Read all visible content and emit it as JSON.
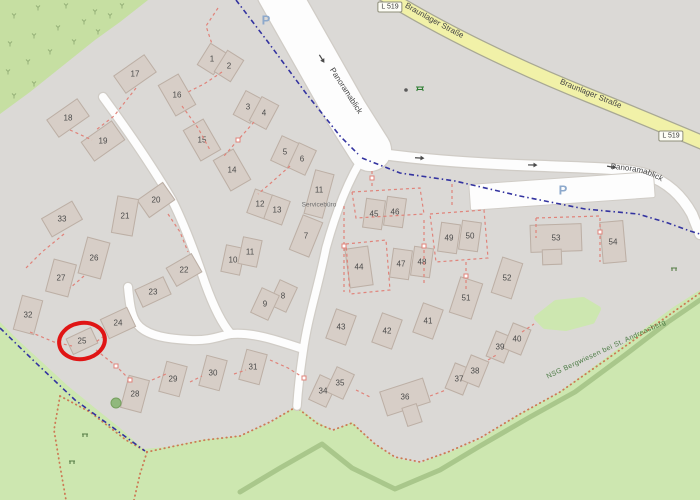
{
  "map": {
    "road_labels": {
      "main_street": "Braunlager Straße",
      "main_street_ref": "L 519",
      "residential_street": "Panoramablick"
    },
    "parking_label": "P",
    "protected_area_label": "NSG Bergwiesen bei St. Andreasberg",
    "service_building_label": "Servicebüro",
    "annotation": {
      "type": "red-circle",
      "around_housenumber": "25",
      "x": 82,
      "y": 341,
      "rx": 23,
      "ry": 18,
      "rotate": -10,
      "color": "#e01515"
    },
    "colors": {
      "background": "#dbd9d6",
      "green_top": "#c6dfa2",
      "green_bottom": "#cde7b0",
      "scrub_mark": "#95b078",
      "treeline": "#a9c78b",
      "building_fill": "#d7cec7",
      "building_stroke": "#bcafa5",
      "road_white": "#fdfdfd",
      "road_casing": "#d0ccc6",
      "road_yellow": "#f1f1a8",
      "road_yellow_casing": "#a8a894",
      "boundary_blue": "#3333a0",
      "parcel_red": "#e0837a",
      "path_orange": "#cc7a55",
      "label_gray": "#4a4a4a",
      "nsg_green": "#4a7a43",
      "annotation_red": "#e01515"
    },
    "buildings": [
      {
        "n": "1",
        "x": 212,
        "y": 59,
        "w": 20,
        "h": 26,
        "r": 32
      },
      {
        "n": "2",
        "x": 229,
        "y": 66,
        "w": 20,
        "h": 26,
        "r": 32
      },
      {
        "n": "3",
        "x": 248,
        "y": 107,
        "w": 20,
        "h": 28,
        "r": 28
      },
      {
        "n": "4",
        "x": 264,
        "y": 113,
        "w": 20,
        "h": 28,
        "r": 28
      },
      {
        "n": "5",
        "x": 285,
        "y": 152,
        "w": 20,
        "h": 28,
        "r": 25
      },
      {
        "n": "6",
        "x": 302,
        "y": 159,
        "w": 20,
        "h": 28,
        "r": 25
      },
      {
        "n": "7",
        "x": 306,
        "y": 236,
        "w": 22,
        "h": 38,
        "r": 22
      },
      {
        "n": "8",
        "x": 283,
        "y": 296,
        "w": 20,
        "h": 28,
        "r": 25
      },
      {
        "n": "9",
        "x": 265,
        "y": 304,
        "w": 20,
        "h": 28,
        "r": 25
      },
      {
        "n": "10",
        "x": 233,
        "y": 260,
        "w": 20,
        "h": 28,
        "r": 12
      },
      {
        "n": "11",
        "x": 250,
        "y": 252,
        "w": 20,
        "h": 28,
        "r": 12
      },
      {
        "n": "12",
        "x": 260,
        "y": 204,
        "w": 20,
        "h": 26,
        "r": 20
      },
      {
        "n": "13",
        "x": 277,
        "y": 210,
        "w": 20,
        "h": 26,
        "r": 20
      },
      {
        "n": "14",
        "x": 232,
        "y": 170,
        "w": 24,
        "h": 36,
        "r": -30
      },
      {
        "n": "15",
        "x": 202,
        "y": 140,
        "w": 24,
        "h": 36,
        "r": -30
      },
      {
        "n": "16",
        "x": 177,
        "y": 95,
        "w": 24,
        "h": 36,
        "r": -30
      },
      {
        "n": "17",
        "x": 135,
        "y": 74,
        "w": 38,
        "h": 22,
        "r": -35
      },
      {
        "n": "18",
        "x": 68,
        "y": 118,
        "w": 38,
        "h": 22,
        "r": -35
      },
      {
        "n": "19",
        "x": 103,
        "y": 141,
        "w": 38,
        "h": 24,
        "r": -35
      },
      {
        "n": "20",
        "x": 156,
        "y": 200,
        "w": 32,
        "h": 22,
        "r": -35
      },
      {
        "n": "21",
        "x": 125,
        "y": 216,
        "w": 22,
        "h": 38,
        "r": 10
      },
      {
        "n": "22",
        "x": 184,
        "y": 270,
        "w": 30,
        "h": 22,
        "r": -30
      },
      {
        "n": "23",
        "x": 153,
        "y": 292,
        "w": 32,
        "h": 20,
        "r": -25
      },
      {
        "n": "24",
        "x": 118,
        "y": 323,
        "w": 30,
        "h": 22,
        "r": -25
      },
      {
        "n": "25",
        "x": 82,
        "y": 341,
        "w": 28,
        "h": 18,
        "r": -25
      },
      {
        "n": "26",
        "x": 94,
        "y": 258,
        "w": 24,
        "h": 38,
        "r": 15
      },
      {
        "n": "27",
        "x": 61,
        "y": 278,
        "w": 24,
        "h": 34,
        "r": 15
      },
      {
        "n": "28",
        "x": 135,
        "y": 394,
        "w": 22,
        "h": 34,
        "r": 15
      },
      {
        "n": "29",
        "x": 173,
        "y": 379,
        "w": 22,
        "h": 32,
        "r": 15
      },
      {
        "n": "30",
        "x": 213,
        "y": 373,
        "w": 22,
        "h": 32,
        "r": 15
      },
      {
        "n": "31",
        "x": 253,
        "y": 367,
        "w": 22,
        "h": 32,
        "r": 15
      },
      {
        "n": "32",
        "x": 28,
        "y": 315,
        "w": 22,
        "h": 36,
        "r": 15
      },
      {
        "n": "33",
        "x": 62,
        "y": 219,
        "w": 36,
        "h": 22,
        "r": -30
      },
      {
        "n": "34",
        "x": 323,
        "y": 391,
        "w": 20,
        "h": 28,
        "r": 25
      },
      {
        "n": "35",
        "x": 340,
        "y": 383,
        "w": 20,
        "h": 28,
        "r": 25
      },
      {
        "n": "36",
        "x": 405,
        "y": 397,
        "w": 46,
        "h": 26,
        "r": -18
      },
      {
        "n": "",
        "x": 412,
        "y": 415,
        "w": 16,
        "h": 20,
        "r": -18
      },
      {
        "n": "37",
        "x": 459,
        "y": 379,
        "w": 20,
        "h": 28,
        "r": 22
      },
      {
        "n": "38",
        "x": 475,
        "y": 371,
        "w": 20,
        "h": 28,
        "r": 22
      },
      {
        "n": "39",
        "x": 500,
        "y": 347,
        "w": 20,
        "h": 28,
        "r": 22
      },
      {
        "n": "40",
        "x": 517,
        "y": 339,
        "w": 20,
        "h": 28,
        "r": 22
      },
      {
        "n": "41",
        "x": 428,
        "y": 321,
        "w": 22,
        "h": 32,
        "r": 20
      },
      {
        "n": "42",
        "x": 387,
        "y": 331,
        "w": 22,
        "h": 32,
        "r": 20
      },
      {
        "n": "43",
        "x": 341,
        "y": 327,
        "w": 22,
        "h": 32,
        "r": 20
      },
      {
        "n": "44",
        "x": 359,
        "y": 267,
        "w": 24,
        "h": 40,
        "r": -8
      },
      {
        "n": "45",
        "x": 374,
        "y": 214,
        "w": 20,
        "h": 30,
        "r": 8
      },
      {
        "n": "46",
        "x": 395,
        "y": 212,
        "w": 20,
        "h": 30,
        "r": 8
      },
      {
        "n": "47",
        "x": 401,
        "y": 264,
        "w": 20,
        "h": 30,
        "r": 8
      },
      {
        "n": "48",
        "x": 422,
        "y": 262,
        "w": 20,
        "h": 30,
        "r": 8
      },
      {
        "n": "49",
        "x": 449,
        "y": 238,
        "w": 20,
        "h": 30,
        "r": 8
      },
      {
        "n": "50",
        "x": 470,
        "y": 236,
        "w": 20,
        "h": 30,
        "r": 8
      },
      {
        "n": "51",
        "x": 466,
        "y": 298,
        "w": 24,
        "h": 38,
        "r": 18
      },
      {
        "n": "52",
        "x": 507,
        "y": 278,
        "w": 22,
        "h": 38,
        "r": 18
      },
      {
        "n": "53",
        "x": 556,
        "y": 238,
        "w": 52,
        "h": 28,
        "r": -2
      },
      {
        "n": "",
        "x": 552,
        "y": 257,
        "w": 20,
        "h": 16,
        "r": -2
      },
      {
        "n": "54",
        "x": 613,
        "y": 242,
        "w": 24,
        "h": 42,
        "r": -5
      },
      {
        "n": "11",
        "x": 319,
        "y": 194,
        "w": 20,
        "h": 46,
        "r": 15,
        "label": "Servicebüro",
        "label_y": 205
      }
    ],
    "geometry": {
      "green_top_left": "0,0 148,0 120,22 95,40 60,68 30,92 0,114",
      "green_bottom": "0,322 18,340 42,362 68,386 95,408 120,428 143,449 168,447 200,440 240,436 270,423 296,406 315,420 333,431 352,422 372,442 395,458 420,463 450,452 482,438 520,414 558,393 600,362 640,332 672,308 700,290 700,500 0,500",
      "green_patch": "537,318 556,303 583,300 598,309 592,321 566,328 545,326",
      "treeline": "240,492 280,468 322,444 352,468 395,489 440,470 480,446 530,417 575,392 625,355 668,322 700,300",
      "yellow_road": "M380,-8 C440,30 520,68 590,96 C630,112 668,128 706,144",
      "road_r1": "M278,-8 L312,52 L346,112 L370,150",
      "road_r2": "M368,152 C420,160 480,164 545,166 C590,168 625,168 645,174 C668,182 682,196 692,214 L700,234",
      "road_r3": "M366,152 C348,180 336,212 326,248 C318,288 308,316 303,352 C300,372 298,390 297,406",
      "road_a": "M103,97 C128,131 152,166 172,200 C184,224 196,256 205,283 C214,308 222,324 231,334",
      "road_r4": "M128,287 C130,308 132,320 140,327 C150,336 168,339 190,340 C210,341 220,336 231,334 C252,332 276,340 303,349",
      "parking_rect": {
        "x": 470,
        "y": 178,
        "w": 185,
        "h": 26,
        "cx": 562,
        "cy": 191,
        "r": -4
      },
      "boundary_blue": [
        "236,0 268,42 305,92 340,136 358,154",
        "362,158 400,173 455,181 520,196 585,209 638,214 668,223 690,231 700,234",
        "0,328 35,362 75,400 108,424 145,451"
      ],
      "red_dashes": [
        "218,8 206,26 212,44",
        "136,88 114,116 96,130",
        "70,130 92,140",
        "182,106 198,128 210,150",
        "222,72 204,84 188,92",
        "254,122 238,140 224,156",
        "290,166 272,182 258,194",
        "352,192 420,188 424,214 356,218 352,192",
        "430,214 484,210 488,258 436,262 430,214",
        "344,206 344,292",
        "346,244 386,240 390,290 350,294 346,244",
        "424,220 424,286",
        "466,262 466,292",
        "536,218 600,216 600,262",
        "536,218 536,238",
        "30,332 54,342 72,346",
        "96,350 116,366 130,380",
        "152,380 166,374",
        "190,382 202,376",
        "234,374 246,370",
        "270,360 288,368 304,378",
        "356,390 372,398",
        "430,396 446,390",
        "488,360 498,354",
        "522,332 534,324",
        "372,186 372,170",
        "452,184 452,208",
        "64,234 42,252 26,268",
        "84,276 70,288",
        "104,336 96,342",
        "168,214 180,232 188,252"
      ],
      "red_nodes": [
        [
          344,
          246
        ],
        [
          424,
          246
        ],
        [
          466,
          276
        ],
        [
          600,
          232
        ],
        [
          372,
          178
        ],
        [
          130,
          380
        ],
        [
          304,
          378
        ],
        [
          238,
          140
        ],
        [
          116,
          366
        ]
      ],
      "orange_paths": [
        "60,396 90,412 126,440 147,452 175,446 205,440 240,436 270,422 296,407 318,424 333,430 352,423 375,444 395,457 420,462 448,452 480,438 520,414 560,392 610,357 655,325 700,293",
        "60,396 54,430 60,466 66,500",
        "147,452 140,474 134,500"
      ],
      "scrub_marks": [
        [
          14,
          16
        ],
        [
          38,
          8
        ],
        [
          66,
          6
        ],
        [
          95,
          12
        ],
        [
          122,
          6
        ],
        [
          10,
          44
        ],
        [
          34,
          36
        ],
        [
          58,
          28
        ],
        [
          84,
          22
        ],
        [
          110,
          16
        ],
        [
          8,
          72
        ],
        [
          28,
          62
        ],
        [
          50,
          52
        ],
        [
          74,
          42
        ],
        [
          98,
          32
        ],
        [
          14,
          96
        ],
        [
          34,
          84
        ]
      ],
      "arrows": [
        {
          "x": 322,
          "y": 59,
          "r": 58
        },
        {
          "x": 420,
          "y": 158,
          "r": 3
        },
        {
          "x": 533,
          "y": 165,
          "r": 1
        },
        {
          "x": 612,
          "y": 167,
          "r": 10
        }
      ],
      "p_positions": [
        {
          "x": 266,
          "y": 20
        },
        {
          "x": 563,
          "y": 190
        }
      ],
      "badge_positions": [
        {
          "x": 390,
          "y": 7
        },
        {
          "x": 671,
          "y": 136
        }
      ],
      "icons": [
        {
          "type": "tree",
          "x": 116,
          "y": 403
        },
        {
          "type": "bench",
          "x": 85,
          "y": 435
        },
        {
          "type": "bench",
          "x": 72,
          "y": 462
        },
        {
          "type": "bench",
          "x": 674,
          "y": 269
        },
        {
          "type": "picnic",
          "x": 420,
          "y": 88
        },
        {
          "type": "waste",
          "x": 406,
          "y": 90
        }
      ],
      "nsg_label_pos": {
        "x": 607,
        "y": 351,
        "rotate": -25
      },
      "r1_label_pos": {
        "x": 344,
        "y": 92,
        "rotate": 57
      }
    }
  }
}
